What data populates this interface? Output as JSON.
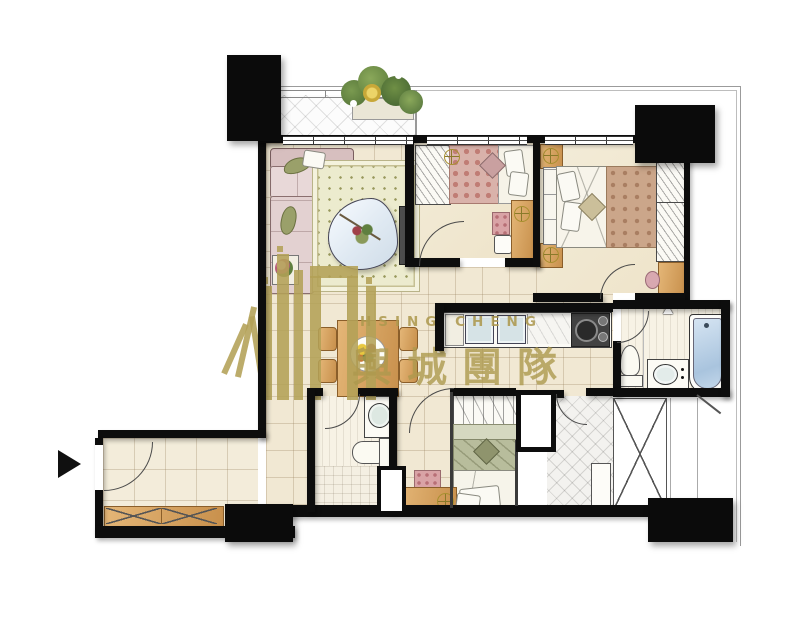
{
  "watermark": {
    "brand_latin": "HSING CHENG",
    "brand_chinese": "興城團隊",
    "color": "#b3a156"
  },
  "palette": {
    "wall": "#0d0d0d",
    "floor": "#f1e8d3",
    "floor_grid_line": "#d6c9ad",
    "wood": "#d8a662",
    "gold_logo": "#b3a156",
    "sofa": "#dcc6c6",
    "rug": "#ecebce",
    "bathtub_water": "#b9cfe7",
    "blanket_master": "#cba68a",
    "blanket_single": "#d9b2aa",
    "blanket_small": "#b8bd9c",
    "boundary_line": "#9b9b9b"
  },
  "icons": {
    "entrance_arrow": "solid-right-triangle",
    "ceiling_light": "gold-circle-crosshair",
    "vent_mark": "triangle-outline"
  }
}
